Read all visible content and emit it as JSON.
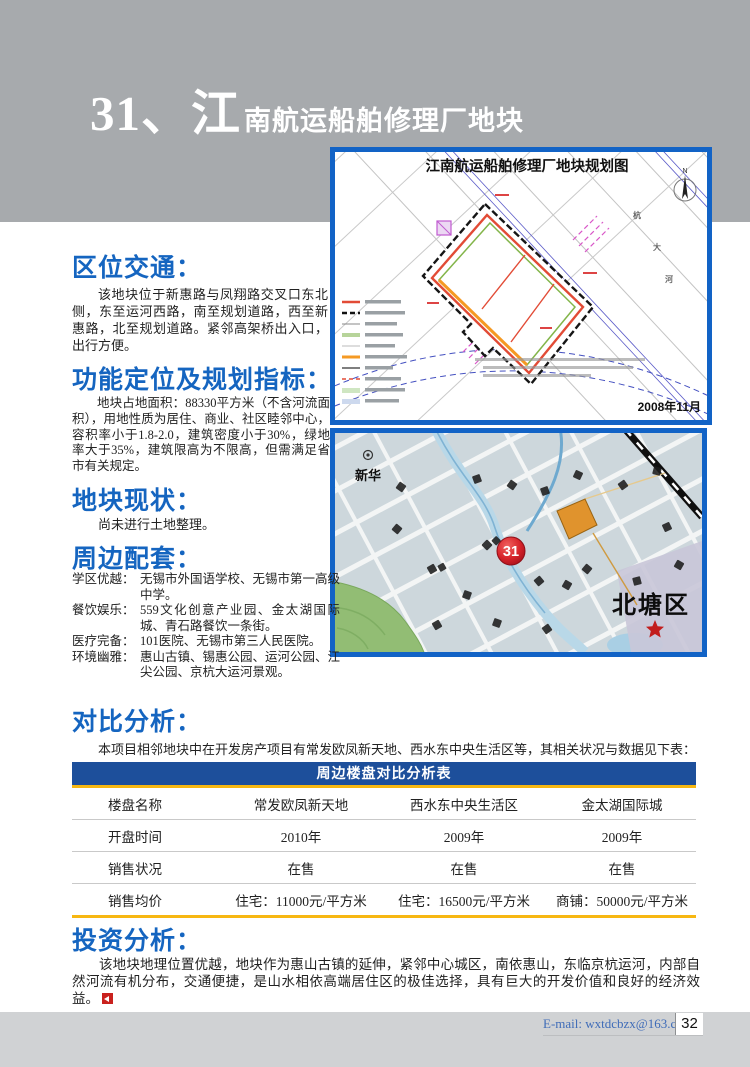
{
  "header": {
    "title_big": "31、江",
    "title_small": "南航运船舶修理厂地块"
  },
  "sections": {
    "location": {
      "title": "区位交通：",
      "body": "该地块位于新惠路与凤翔路交叉口东北侧，东至运河西路，南至规划道路，西至新惠路，北至规划道路。紧邻高架桥出入口，出行方便。"
    },
    "function": {
      "title": "功能定位及规划指标：",
      "body": "地块占地面积：88330平方米（不含河流面积），用地性质为居住、商业、社区睦邻中心，容积率小于1.8-2.0，建筑密度小于30%，绿地率大于35%，建筑限高为不限高，但需满足省市有关规定。"
    },
    "status": {
      "title": "地块现状：",
      "body": "尚未进行土地整理。"
    },
    "surroundings": {
      "title": "周边配套：",
      "items": [
        {
          "label": "学区优越：",
          "text": "无锡市外国语学校、无锡市第一高级中学。"
        },
        {
          "label": "餐饮娱乐：",
          "text": "559文化创意产业园、金太湖国际城、青石路餐饮一条街。"
        },
        {
          "label": "医疗完备：",
          "text": "101医院、无锡市第三人民医院。"
        },
        {
          "label": "环境幽雅：",
          "text": "惠山古镇、锡惠公园、运河公园、江尖公园、京杭大运河景观。"
        }
      ]
    },
    "comparison": {
      "title": "对比分析：",
      "intro": "本项目相邻地块中在开发房产项目有常发欧凤新天地、西水东中央生活区等，其相关状况与数据见下表："
    },
    "investment": {
      "title": "投资分析：",
      "body": "该地块地理位置优越，地块作为惠山古镇的延伸，紧邻中心城区，南依惠山，东临京杭运河，内部自然河流有机分布，交通便捷，是山水相依高端居住区的极佳选择，具有巨大的开发价值和良好的经济效益。"
    }
  },
  "table": {
    "title": "周边楼盘对比分析表",
    "headers": [
      "楼盘名称",
      "常发欧凤新天地",
      "西水东中央生活区",
      "金太湖国际城"
    ],
    "rows": [
      [
        "开盘时间",
        "2010年",
        "2009年",
        "2009年"
      ],
      [
        "销售状况",
        "在售",
        "在售",
        "在售"
      ],
      [
        "销售均价",
        "住宅：11000元/平方米",
        "住宅：16500元/平方米",
        "商铺：50000元/平方米"
      ]
    ]
  },
  "planning_map": {
    "title": "江南航运船舶修理厂地块规划图",
    "date": "2008年11月",
    "north_label": "N",
    "geo_labels": [
      "杭",
      "大",
      "河"
    ]
  },
  "location_map": {
    "marker": "31",
    "district": "北塘区",
    "place": "新华"
  },
  "footer": {
    "email": "E-mail: wxtdcbzx@163.com",
    "page_number": "32"
  },
  "colors": {
    "accent_blue": "#1565c0",
    "table_navy": "#1d4f9b",
    "highlight_yellow": "#f7b711",
    "marker_red": "#d42027",
    "header_gray": "#a7aaad",
    "footer_gray": "#d0d2d4"
  }
}
